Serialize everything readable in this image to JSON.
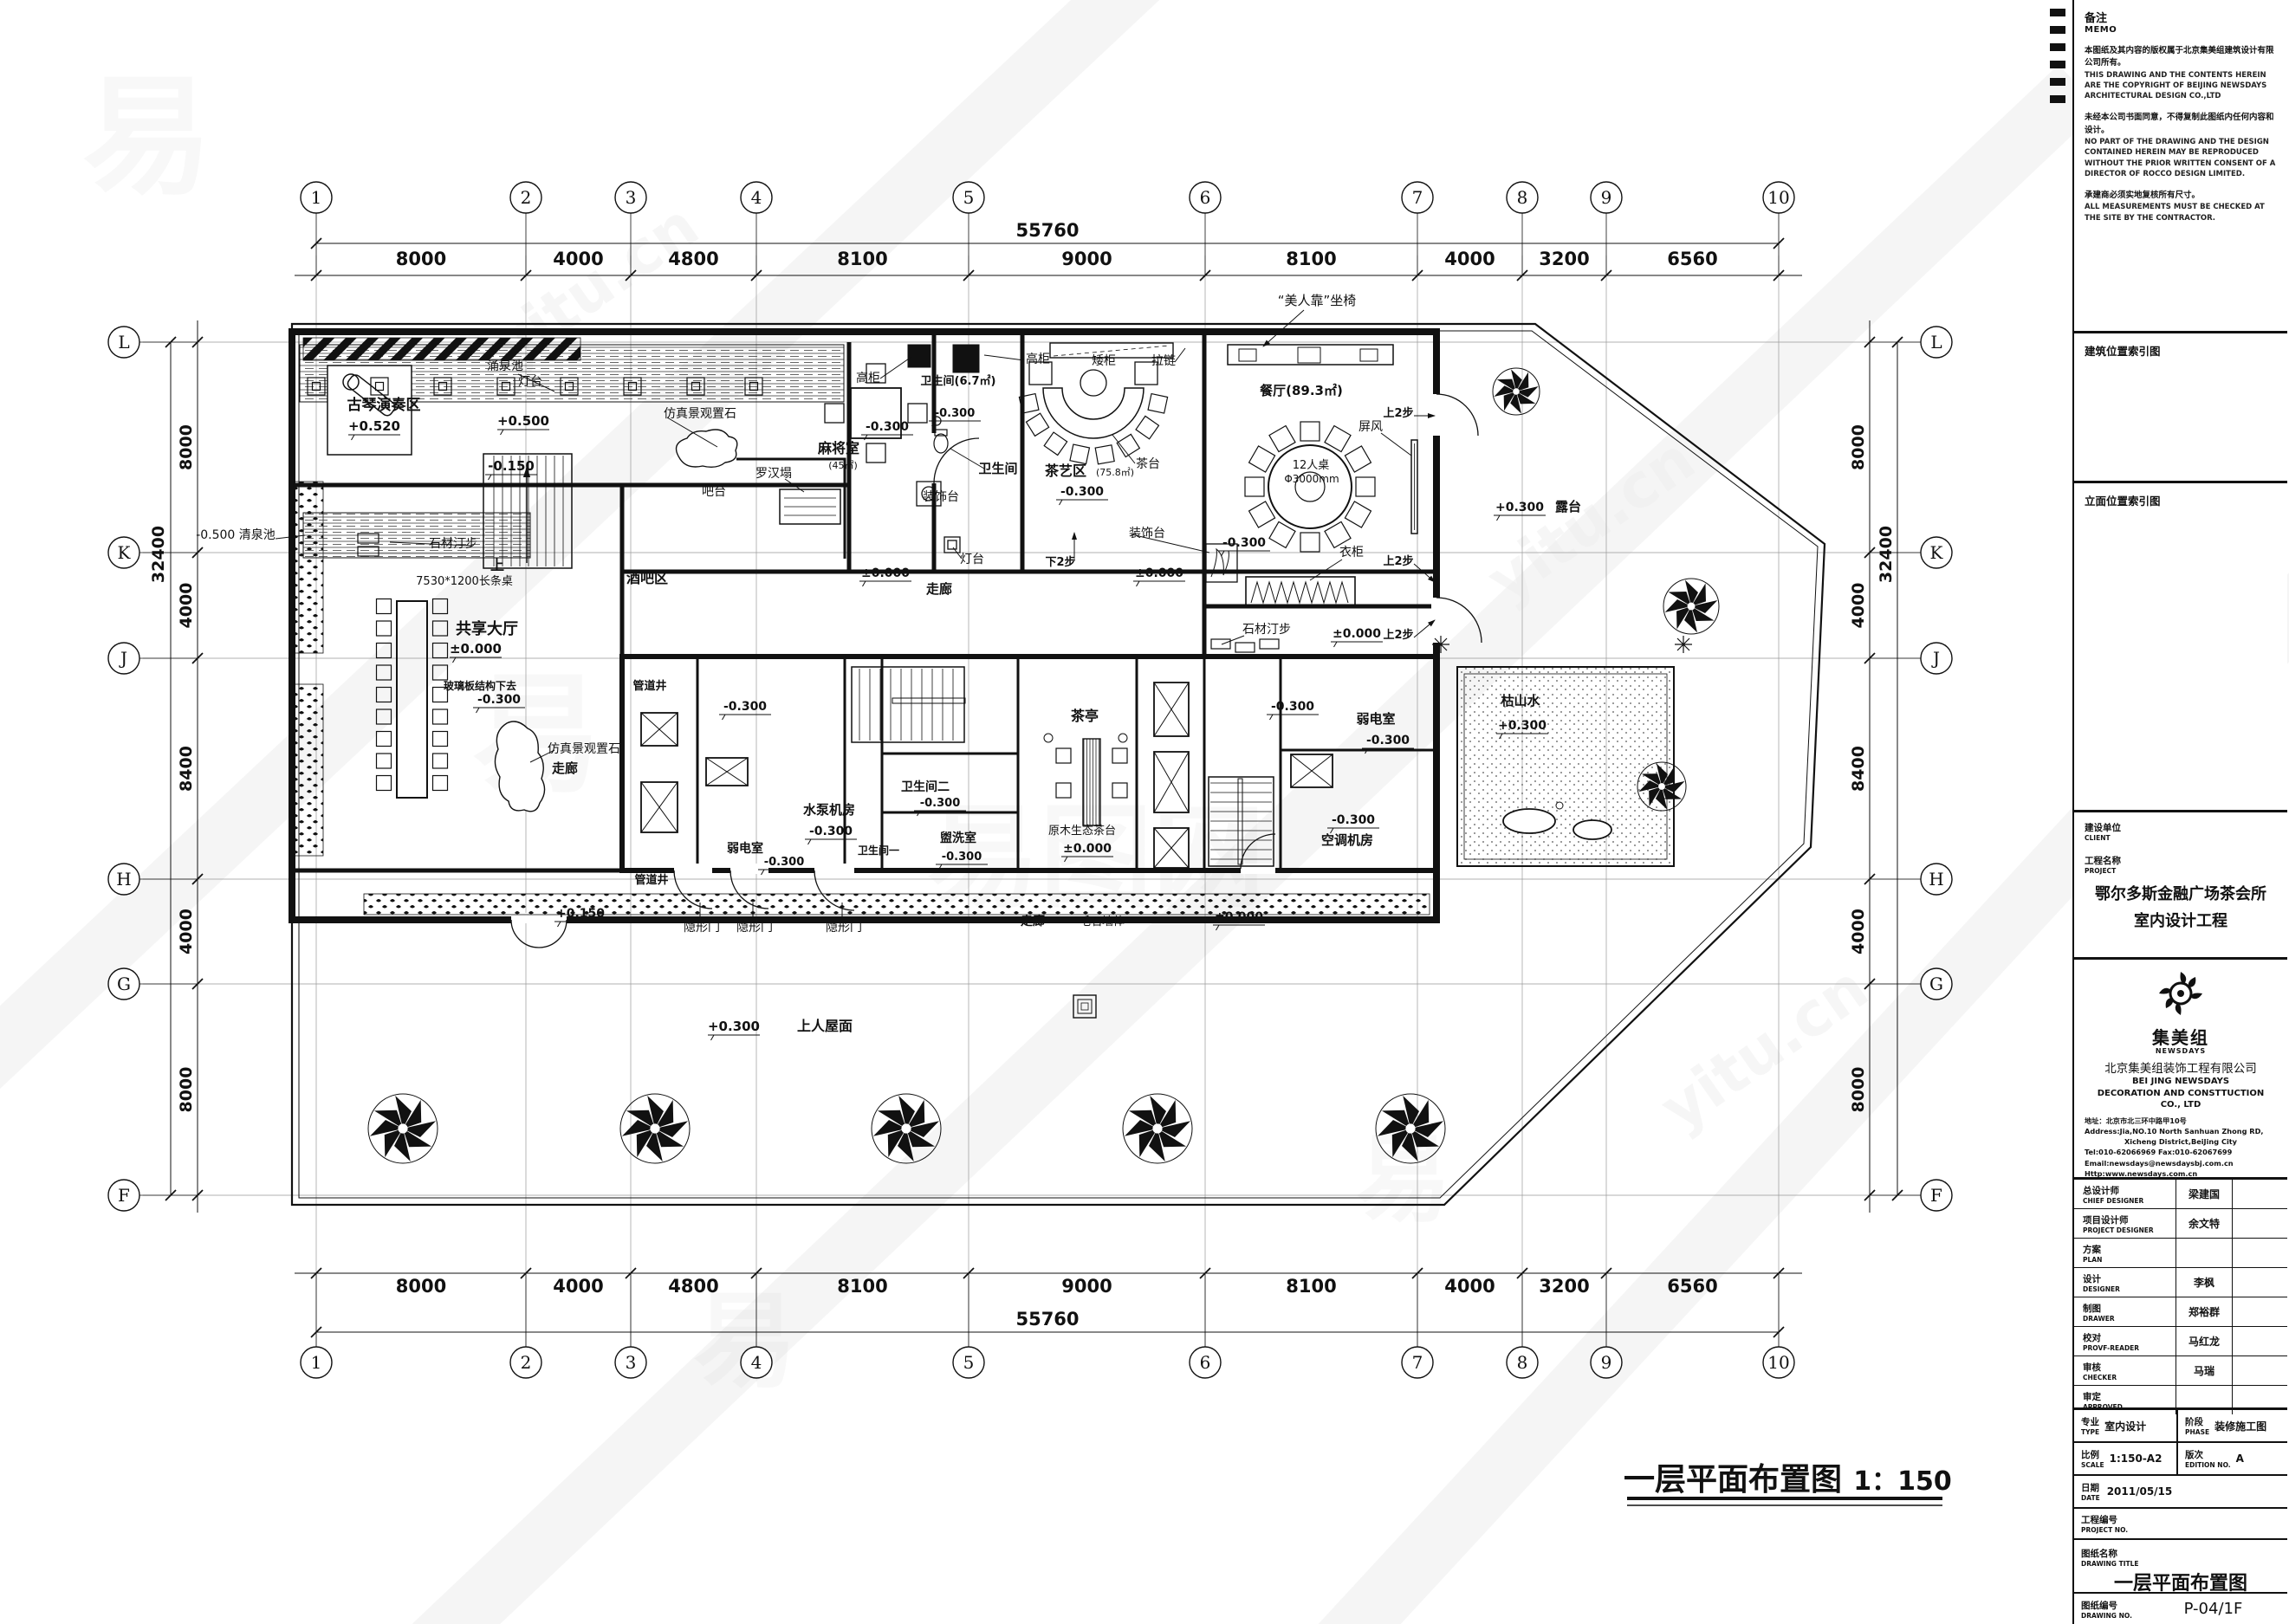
{
  "watermark": {
    "glyph": "易",
    "brand": "易图网",
    "site": "yitu.cn"
  },
  "grid": {
    "col_labels": [
      "1",
      "2",
      "3",
      "4",
      "5",
      "6",
      "7",
      "8",
      "9",
      "10"
    ],
    "col_dims": [
      "8000",
      "4000",
      "4800",
      "8100",
      "9000",
      "8100",
      "4000",
      "3200",
      "6560"
    ],
    "col_total": "55760",
    "row_labels": [
      "L",
      "K",
      "J",
      "H",
      "G",
      "F"
    ],
    "row_dims": [
      "8000",
      "4000",
      "8400",
      "4000",
      "8000"
    ],
    "row_total": "32400"
  },
  "plan": {
    "drawing_title": "一层平面布置图",
    "drawing_scale": "1：150",
    "labels": {
      "guqin": "古琴演奏区",
      "guqin_lv": "+0.520",
      "yongquanchi": "涌泉池",
      "dengtai1": "灯台",
      "p500": "+0.500",
      "m150": "-0.150",
      "fz1": "仿真景观置石",
      "luohanta": "罗汉塌",
      "batai": "吧台",
      "jiubaqu": "酒吧区",
      "shangU": "上",
      "changtiao": "7530*1200长条桌",
      "shicai2": "石材汀步",
      "gongxiang": "共享大厅",
      "gx_lv": "±0.000",
      "boli": "玻璃板结构下去",
      "boli_lv": "-0.300",
      "fz2": "仿真景观置石",
      "zoulang1": "走廊",
      "qingquan": "-0.500 清泉池",
      "majiang": "麻将室",
      "majiang_area": "(45㎡)",
      "mj_lv": "-0.300",
      "gaogui1": "高柜",
      "gaogui2": "高柜",
      "aigui": "矮柜",
      "lalian": "拉链",
      "wsj1": "卫生间(6.7㎡)",
      "wsj1_lv": "-0.300",
      "wsjldr": "卫生间",
      "chayi": "茶艺区",
      "chayi_area": "(75.8㎡)",
      "chayi_lv": "-0.300",
      "chatai": "茶台",
      "canting": "餐厅(89.3㎡)",
      "meirenkao": "“美人靠”坐椅",
      "r12": "12人桌",
      "r12d": "Φ3000mm",
      "pingfeng": "屏风",
      "s2b1": "上2步",
      "s2b2": "上2步",
      "s2b3": "上2步",
      "yigui": "衣柜",
      "din_lv": "-0.300",
      "shicai3": "石材汀步",
      "pm0b": "±0.000",
      "lutai_lv": "+0.300",
      "lutai": "露台",
      "zoulang2": "走廊",
      "corlv1": "±0.000",
      "corlv2": "±0.000",
      "x2b": "下2步",
      "zsd1": "装饰台",
      "zsd2": "装饰台",
      "dengtai2": "灯台",
      "gdj1": "管道井",
      "gdj2": "管道井",
      "corelv1": "-0.300",
      "ruodian1": "弱电室",
      "rd1lv": "-0.300",
      "shuibeng": "水泵机房",
      "sblv": "-0.300",
      "wsj2": "卫生间二",
      "wsj2lv": "-0.300",
      "guanxi": "盥洗室",
      "gxlv": "-0.300",
      "wsy1": "卫生间一",
      "chating": "茶亭",
      "ymst": "原木生态茶台",
      "ctlv": "±0.000",
      "corelv2": "-0.300",
      "ruodian2": "弱电室",
      "rd2lv": "-0.300",
      "ktlv": "-0.300",
      "ktjf": "空调机房",
      "yxm1": "隐形门",
      "yxm2": "隐形门",
      "yxm3": "隐形门",
      "p150": "+0.150",
      "zoulang3": "走廊",
      "maoshi": "毛石墙体",
      "corlv3": "±0.000",
      "rooflv": "+0.300",
      "roof": "上人屋面",
      "kss": "枯山水",
      "ksslv": "+0.300"
    }
  },
  "titleblock": {
    "memo_zh": "备注",
    "memo_en": "MEMO",
    "memo1_zh": "本图纸及其内容的版权属于北京集美组建筑设计有限公司所有。",
    "memo1_en": "THIS DRAWING AND THE CONTENTS HEREIN ARE THE COPYRIGHT OF BEIJING NEWSDAYS ARCHITECTURAL DESIGN CO.,LTD",
    "memo2_zh": "未经本公司书面同意，不得复制此图纸内任何内容和设计。",
    "memo2_en": "NO PART OF THE DRAWING AND THE DESIGN CONTAINED HEREIN MAY BE REPRODUCED WITHOUT THE PRIOR WRITTEN CONSENT OF A DIRECTOR OF ROCCO DESIGN LIMITED.",
    "memo3_zh": "承建商必须实地复核所有尺寸。",
    "memo3_en": "ALL MEASUREMENTS MUST BE CHECKED AT THE SITE BY THE CONTRACTOR.",
    "sec_arch_index": "建筑位置索引图",
    "sec_elev_index": "立面位置索引图",
    "client_zh": "建设单位",
    "client_en": "CLIENT",
    "project_zh": "工程名称",
    "project_en": "PROJECT",
    "project_name1": "鄂尔多斯金融广场茶会所",
    "project_name2": "室内设计工程",
    "logo_cn": "集美组",
    "logo_en": "NEWSDAYS",
    "co_cn": "北京集美组装饰工程有限公司",
    "co_en1": "BEI JING NEWSDAYS",
    "co_en2": "DECORATION AND CONSTTUCTION",
    "co_en3": "CO., LTD",
    "addr_cn": "地址：北京市北三环中路甲10号",
    "addr_en1": "Address:Jia,NO.10 North Sanhuan Zhong RD,",
    "addr_en2": "Xicheng District,BeiJing City",
    "tel": "Tel:010-62066969  Fax:010-62067699",
    "email": "Email:newsdays@newsdaysbj.com.cn",
    "web": "Http:www.newsdays.com.cn",
    "people": [
      {
        "zh": "总设计师",
        "en": "CHIEF DESIGNER",
        "val": "梁建国"
      },
      {
        "zh": "项目设计师",
        "en": "PROJECT DESIGNER",
        "val": "余文特"
      },
      {
        "zh": "方案",
        "en": "PLAN",
        "val": ""
      },
      {
        "zh": "设计",
        "en": "DESIGNER",
        "val": "李枫"
      },
      {
        "zh": "制图",
        "en": "DRAWER",
        "val": "郑裕群"
      },
      {
        "zh": "校对",
        "en": "PROVF-READER",
        "val": "马红龙"
      },
      {
        "zh": "审核",
        "en": "CHECKER",
        "val": "马瑞"
      },
      {
        "zh": "审定",
        "en": "APPROVED",
        "val": ""
      }
    ],
    "type_zh": "专业",
    "type_en": "TYPE",
    "type_val": "室内设计",
    "phase_zh": "阶段",
    "phase_en": "PHASE",
    "phase_val": "装修施工图",
    "scale_zh": "比例",
    "scale_en": "SCALE",
    "scale_val": "1:150-A2",
    "edition_zh": "版次",
    "edition_en": "EDITION NO.",
    "edition_val": "A",
    "date_zh": "日期",
    "date_en": "DATE",
    "date_val": "2011/05/15",
    "projno_zh": "工程编号",
    "projno_en": "PROJECT NO.",
    "projno_val": "",
    "dwgtitle_zh": "图纸名称",
    "dwgtitle_en": "DRAWING TITLE",
    "dwgtitle_val": "一层平面布置图",
    "dwgno_zh": "图纸编号",
    "dwgno_en": "DRAWING NO.",
    "dwgno_val": "P-04/1F"
  }
}
